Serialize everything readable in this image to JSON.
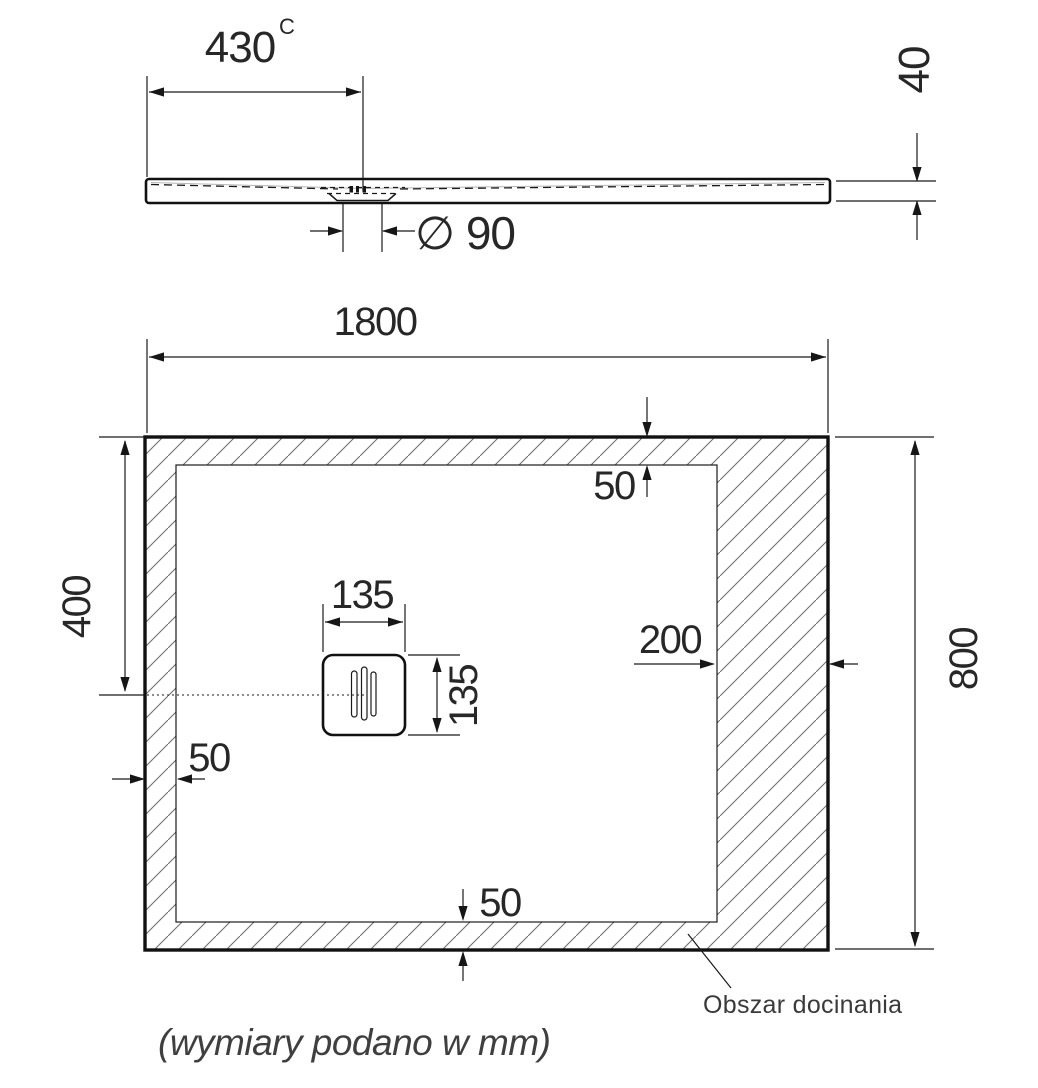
{
  "drawing": {
    "title_note": "(wymiary podano w mm)",
    "side_view": {
      "dim_430": {
        "value": "430",
        "sup": "C"
      },
      "dim_40": "40",
      "dim_diameter": "∅ 90"
    },
    "plan_view": {
      "dim_1800": "1800",
      "dim_800": "800",
      "dim_400": "400",
      "dim_135_width": "135",
      "dim_135_height": "135",
      "dim_200": "200",
      "dim_50_top": "50",
      "dim_50_left": "50",
      "dim_50_bottom": "50",
      "trim_area_label": "Obszar docinania"
    },
    "colors": {
      "line": "#1a1a1a",
      "hatch": "#6f6f6f",
      "text": "#272727",
      "muted_text": "#3a3a3a",
      "background": "#ffffff"
    }
  }
}
